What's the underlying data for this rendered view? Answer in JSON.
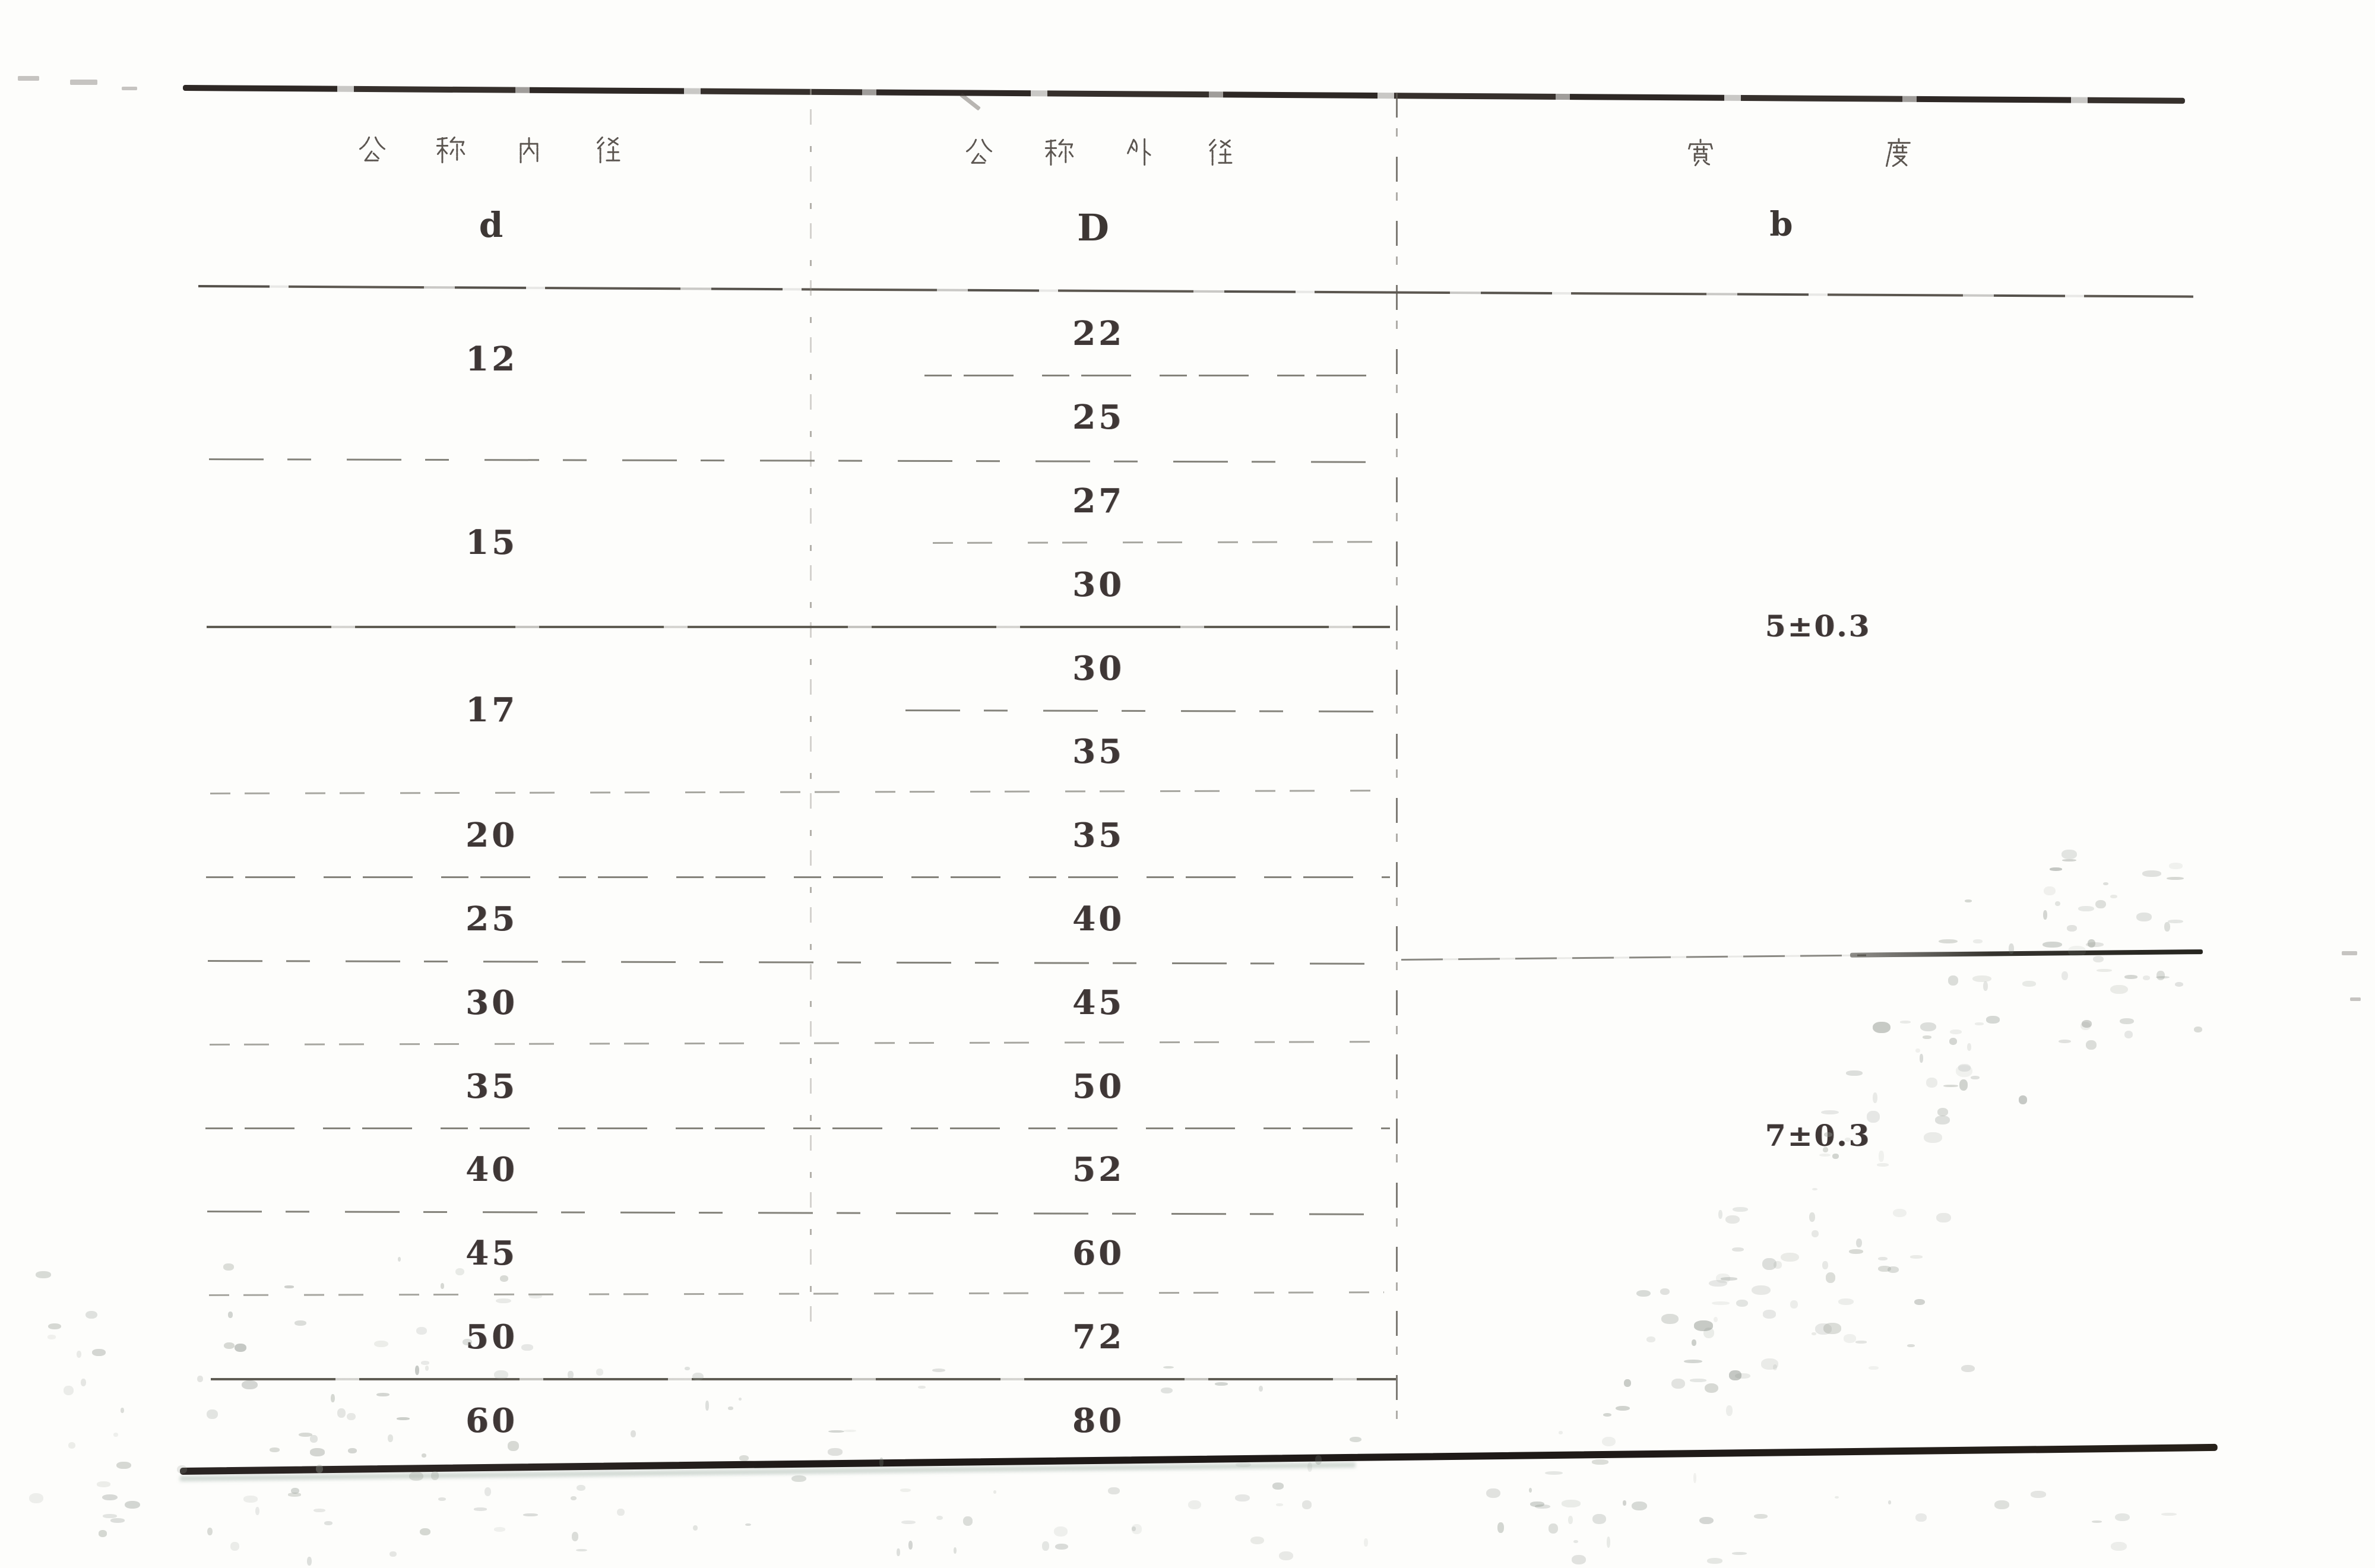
{
  "page": {
    "kind": "scanned standards table",
    "paper_color": "#fdfdfb",
    "ink_color": "#3f3736",
    "rule_color": "#6e6d64"
  },
  "table": {
    "columns": [
      {
        "title": "公称内径",
        "symbol": "d"
      },
      {
        "title": "公称外径",
        "symbol": "D"
      },
      {
        "title": "宽度",
        "symbol": "b"
      }
    ],
    "groups": [
      {
        "d": "12",
        "D": [
          "22",
          "25"
        ]
      },
      {
        "d": "15",
        "D": [
          "27",
          "30"
        ]
      },
      {
        "d": "17",
        "D": [
          "30",
          "35"
        ]
      },
      {
        "d": "20",
        "D": [
          "35"
        ]
      },
      {
        "d": "25",
        "D": [
          "40"
        ]
      },
      {
        "d": "30",
        "D": [
          "45"
        ]
      },
      {
        "d": "35",
        "D": [
          "50"
        ]
      },
      {
        "d": "40",
        "D": [
          "52"
        ]
      },
      {
        "d": "45",
        "D": [
          "60"
        ]
      },
      {
        "d": "50",
        "D": [
          "72"
        ]
      },
      {
        "d": "60",
        "D": [
          "80"
        ]
      }
    ],
    "widths": [
      {
        "b": "5±0.3",
        "rows": 8
      },
      {
        "b": "7±0.3",
        "rows": 6
      }
    ]
  }
}
